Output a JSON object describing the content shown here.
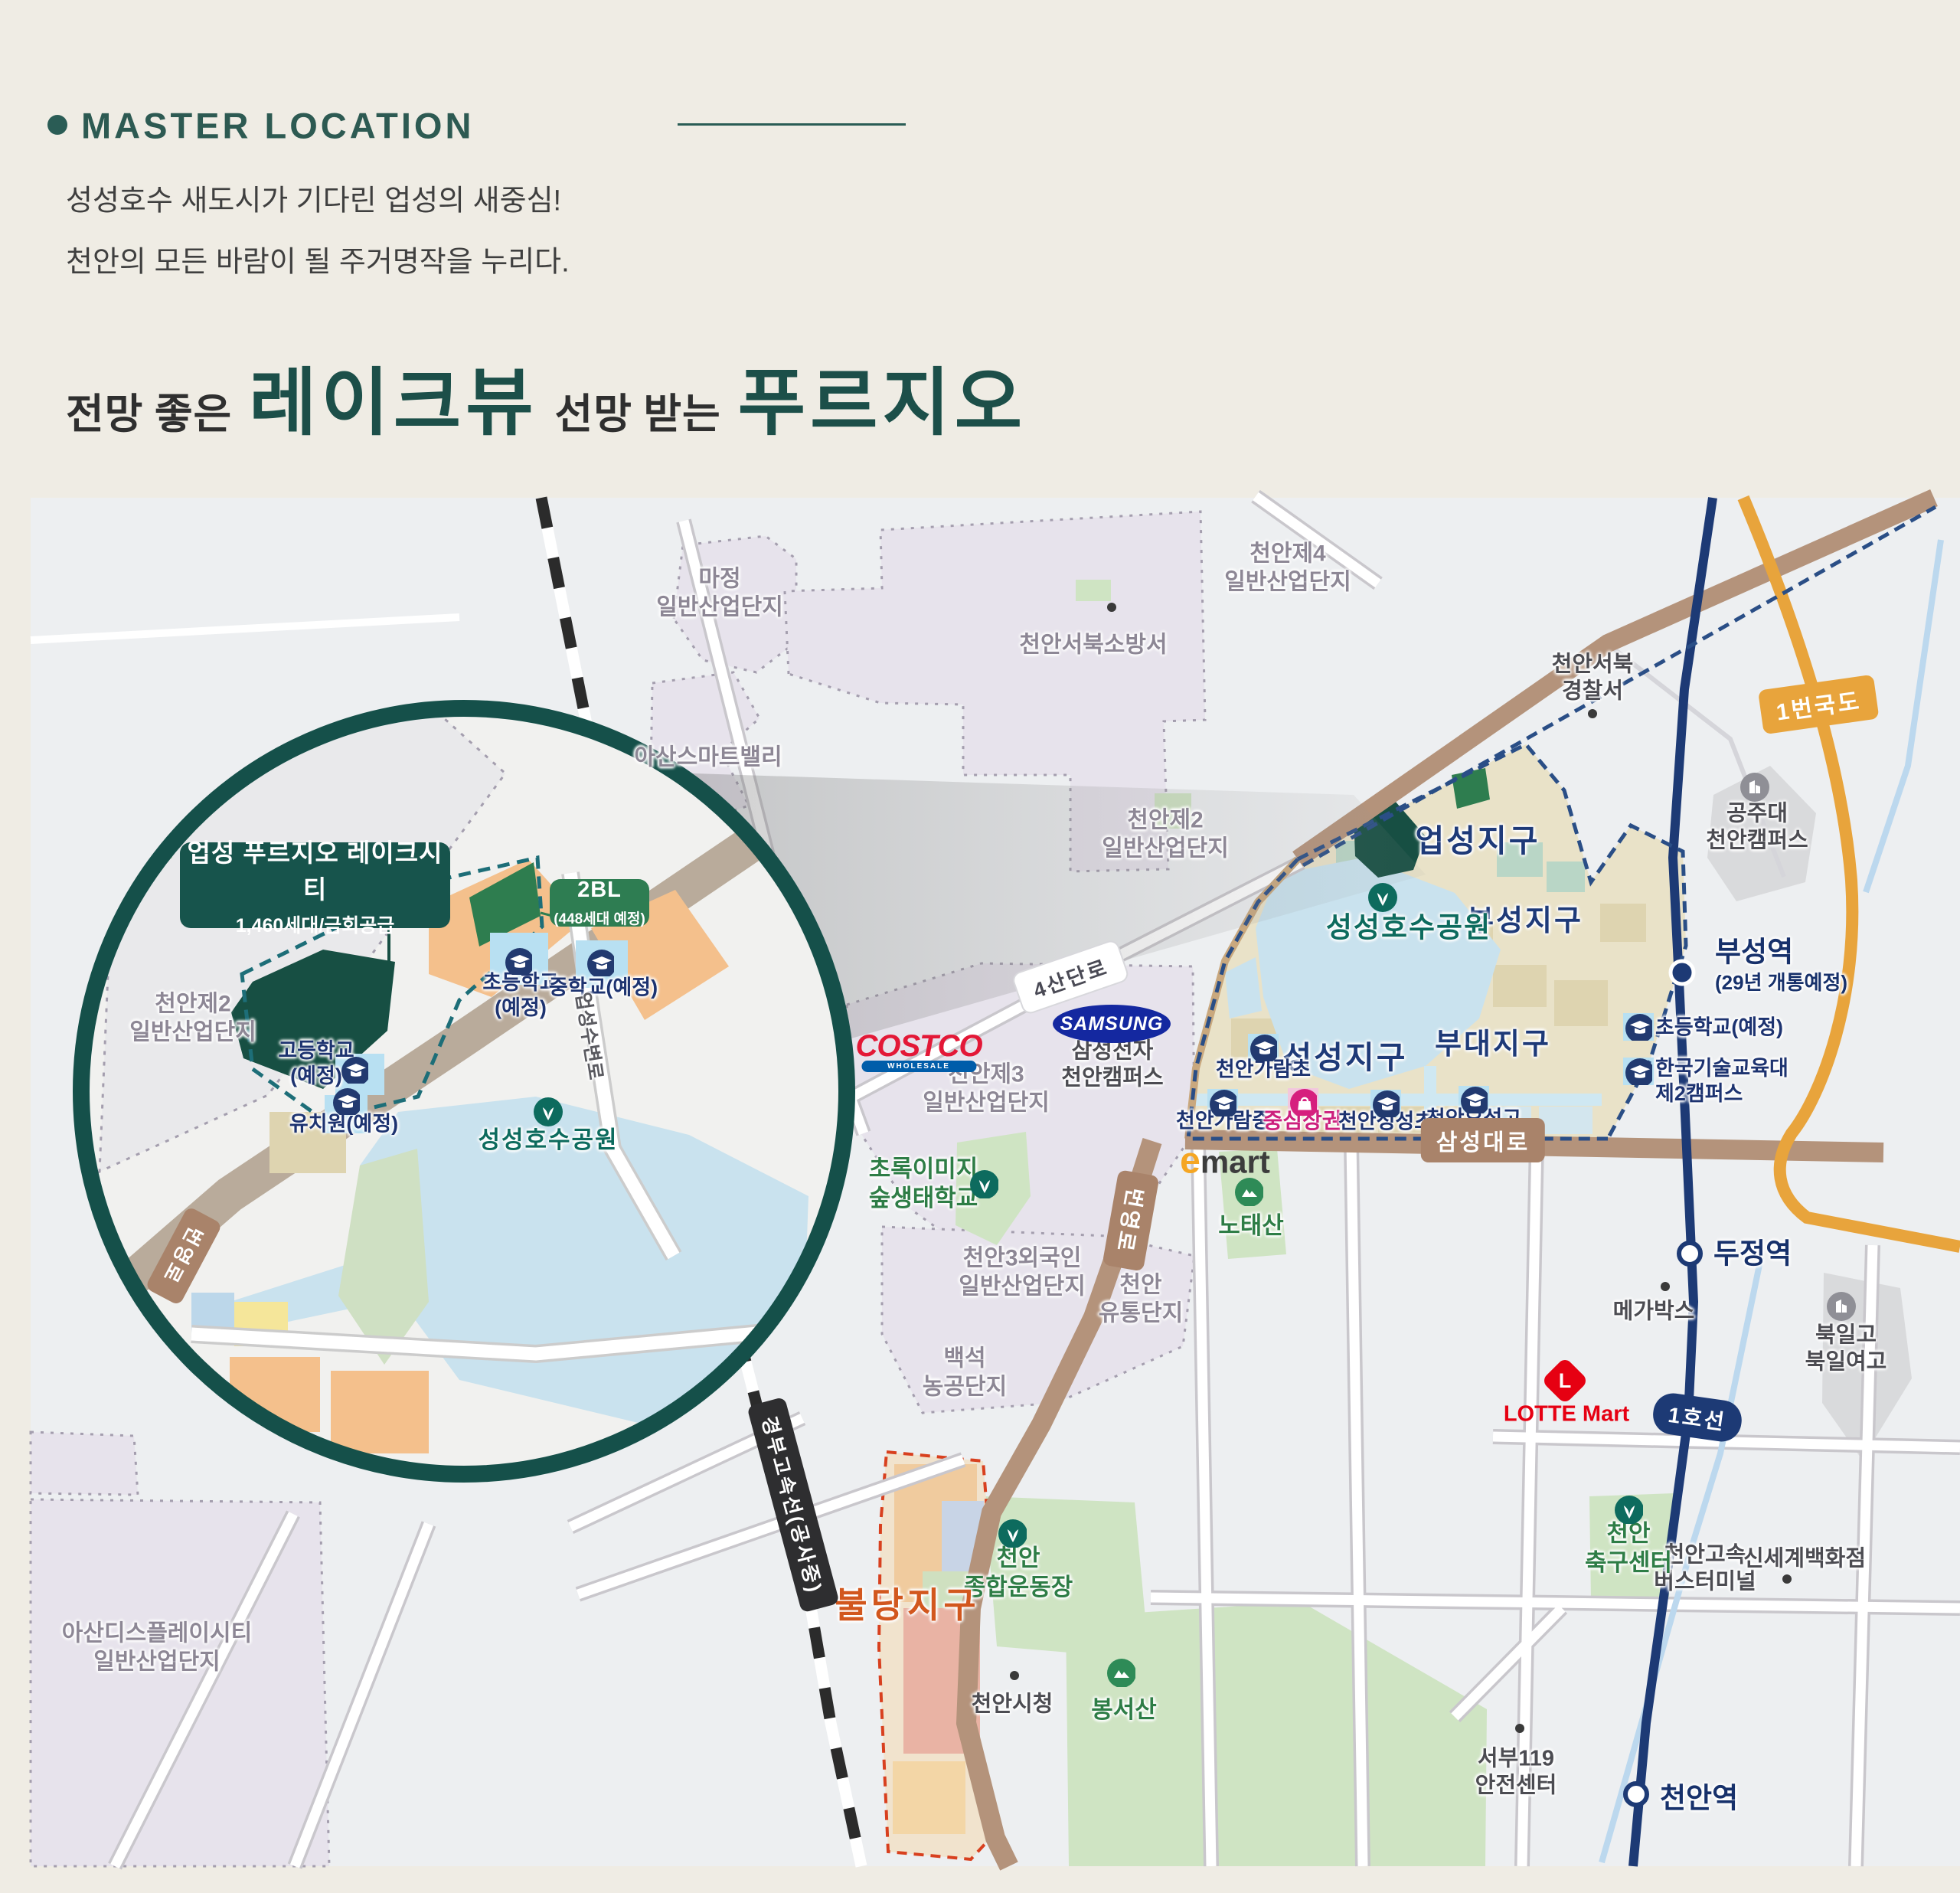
{
  "header": {
    "section_title": "MASTER LOCATION",
    "desc_line1": "성성호수 새도시가 기다린 업성의 새중심!",
    "desc_line2": "천안의 모든 바람이 될 주거명작을 누리다.",
    "headline": {
      "pre": "전망 좋은",
      "em1": "레이크뷰",
      "mid": "선망 받는",
      "em2": "푸르지오"
    }
  },
  "inset": {
    "site_box": {
      "title": "업성 푸르지오 레이크시티",
      "subtitle": "1,460세대/금회공급"
    },
    "bl2_box": {
      "title": "2BL",
      "subtitle": "(448세대 예정)"
    },
    "labels": [
      {
        "text": "천안제2\n일반산업단지"
      },
      {
        "text": "고등학교\n(예정)"
      },
      {
        "text": "유치원(예정)"
      },
      {
        "text": "초등학교\n(예정)"
      },
      {
        "text": "중학교(예정)"
      },
      {
        "text": "성성호수공원"
      },
      {
        "text": "업성수변로"
      }
    ],
    "badge": {
      "text": "번영로"
    }
  },
  "map": {
    "labels": [
      {
        "text": "마정\n일반산업단지"
      },
      {
        "text": "천안제4\n일반산업단지"
      },
      {
        "text": "천안서북소방서"
      },
      {
        "text": "아산스마트밸리"
      },
      {
        "text": "천안제2\n일반산업단지"
      },
      {
        "text": "천안제3\n일반산업단지"
      },
      {
        "text": "천안3외국인\n일반산업단지"
      },
      {
        "text": "천안\n유통단지"
      },
      {
        "text": "백석\n농공단지"
      },
      {
        "text": "아산디스플레이시티\n일반산업단지"
      },
      {
        "text": "천안서북\n경찰서"
      },
      {
        "text": "메가박스"
      },
      {
        "text": "천안시청"
      },
      {
        "text": "천안고속\n버스터미널"
      },
      {
        "text": "신세계백화점"
      },
      {
        "text": "서부119\n안전센터"
      },
      {
        "text": "공주대\n천안캠퍼스"
      },
      {
        "text": "북일고\n북일여고"
      },
      {
        "text": "삼성전자\n천안캠퍼스"
      },
      {
        "text": "초록이미지\n숲생태학교"
      },
      {
        "text": "노태산"
      },
      {
        "text": "천안\n종합운동장"
      },
      {
        "text": "봉서산"
      },
      {
        "text": "천안\n축구센터"
      },
      {
        "text": "업성지구"
      },
      {
        "text": "부성지구"
      },
      {
        "text": "성성지구"
      },
      {
        "text": "부대지구"
      },
      {
        "text": "불당지구"
      },
      {
        "text": "성성호수공원"
      },
      {
        "text": "천안가람초"
      },
      {
        "text": "천안가람중"
      },
      {
        "text": "중심상권"
      },
      {
        "text": "천안성성초"
      },
      {
        "text": "천안오성고"
      },
      {
        "text": "초등학교(예정)"
      },
      {
        "text": "한국기술교육대\n제2캠퍼스"
      }
    ],
    "badges": [
      {
        "text": "1번국도"
      },
      {
        "text": "4산단로"
      },
      {
        "text": "번영로"
      },
      {
        "text": "삼성대로"
      },
      {
        "text": "1호선"
      },
      {
        "text": "경부고속선(공사중)"
      }
    ],
    "stations": [
      {
        "name": "부성역",
        "note": "(29년 개통예정)"
      },
      {
        "name": "두정역"
      },
      {
        "name": "천안역"
      }
    ],
    "logos": {
      "costco": "COSTCO",
      "costco_sub": "WHOLESALE",
      "samsung": "SAMSUNG",
      "emart_e": "e",
      "emart_mart": "mart",
      "lotte_l": "L",
      "lotte_text": "LOTTE Mart"
    },
    "icons": [
      "school-icon",
      "park-icon",
      "mountain-icon",
      "shop-icon",
      "building-icon",
      "location-dot",
      "station-marker"
    ]
  }
}
